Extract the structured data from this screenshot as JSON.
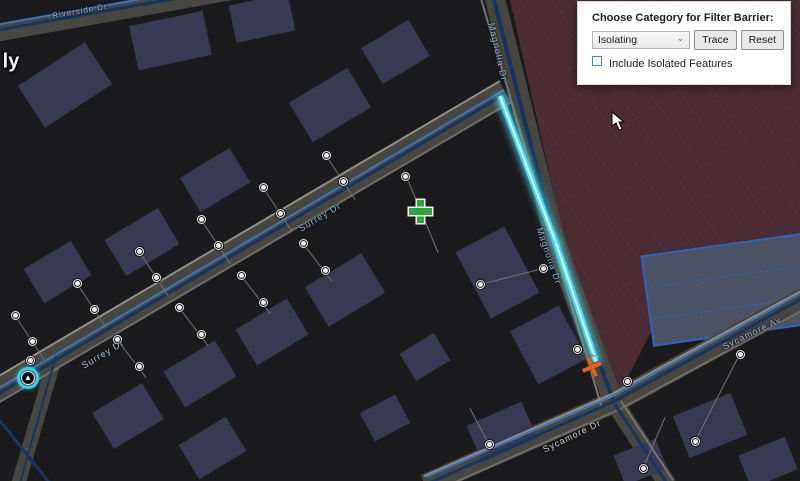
{
  "panel": {
    "title": "Choose Category for Filter Barrier:",
    "dropdown_value": "Isolating",
    "trace_label": "Trace",
    "reset_label": "Reset",
    "checkbox_label": "Include Isolated Features",
    "checkbox_checked": false
  },
  "map": {
    "colors": {
      "background": "#1b1b1e",
      "building": "#383a53",
      "road": "#474641",
      "road_edge": "#8f8d84",
      "water_main_dark": "#16365f",
      "water_main_blue": "#3b76bd",
      "trace_highlight": "#49dbf2",
      "red_zone": "#4a2c32",
      "lot_fill": "#4b5364",
      "lot_border": "#2d64c2",
      "label_blue": "#8fb3dd",
      "start_marker_green": "#2fa33c",
      "barrier_orange": "#e2621b"
    },
    "zones": {
      "red_clip": "polygon(510px 0px, 800px 0px, 800px 248px, 690px 255px, 652px 330px, 620px 392px, 565px 243px)",
      "lot": {
        "x": 733,
        "y": 289,
        "w": 175,
        "h": 92,
        "rot": -8
      }
    },
    "roads": [
      {
        "x1": -20,
        "y1": 400,
        "x2": 505,
        "y2": 92,
        "w": 22
      },
      {
        "x1": 494,
        "y1": -5,
        "x2": 556,
        "y2": 244,
        "w": 20
      },
      {
        "x1": 556,
        "y1": 244,
        "x2": 614,
        "y2": 404,
        "w": 20
      },
      {
        "x1": 425,
        "y1": 485,
        "x2": 614,
        "y2": 402,
        "w": 22
      },
      {
        "x1": 614,
        "y1": 402,
        "x2": 805,
        "y2": 298,
        "w": 22
      },
      {
        "x1": 614,
        "y1": 402,
        "x2": 668,
        "y2": 485,
        "w": 18
      },
      {
        "x1": -5,
        "y1": 34,
        "x2": 232,
        "y2": -8,
        "w": 16
      },
      {
        "x1": 55,
        "y1": 358,
        "x2": 18,
        "y2": 485,
        "w": 14
      }
    ],
    "lines": [
      {
        "x1": -25,
        "y1": 390,
        "x2": 500,
        "y2": 81,
        "w": 2,
        "c": "#8f8d84"
      },
      {
        "x1": -14,
        "y1": 410,
        "x2": 511,
        "y2": 102,
        "w": 1.5,
        "c": "#6e6c64"
      },
      {
        "x1": -18,
        "y1": 403,
        "x2": 503,
        "y2": 95,
        "w": 3,
        "c": "#16365f"
      },
      {
        "x1": -16,
        "y1": 397,
        "x2": 504,
        "y2": 90,
        "w": 2,
        "c": "#3b76bd"
      },
      {
        "x1": 481,
        "y1": -2,
        "x2": 602,
        "y2": 408,
        "w": 1.5,
        "c": "#76746c"
      },
      {
        "x1": 494,
        "y1": 0,
        "x2": 556,
        "y2": 244,
        "w": 4,
        "c": "#16365f"
      },
      {
        "x1": 556,
        "y1": 244,
        "x2": 613,
        "y2": 400,
        "w": 4,
        "c": "#16365f"
      },
      {
        "x1": 424,
        "y1": 476,
        "x2": 612,
        "y2": 394,
        "w": 2,
        "c": "#8f8d84"
      },
      {
        "x1": 433,
        "y1": 492,
        "x2": 618,
        "y2": 410,
        "w": 1.5,
        "c": "#6e6c64"
      },
      {
        "x1": 428,
        "y1": 483,
        "x2": 614,
        "y2": 401,
        "w": 3,
        "c": "#16365f"
      },
      {
        "x1": 426,
        "y1": 477,
        "x2": 613,
        "y2": 396,
        "w": 2,
        "c": "#3b76bd"
      },
      {
        "x1": 612,
        "y1": 394,
        "x2": 803,
        "y2": 290,
        "w": 2,
        "c": "#8f8d84"
      },
      {
        "x1": 618,
        "y1": 410,
        "x2": 805,
        "y2": 309,
        "w": 1.5,
        "c": "#6e6c64"
      },
      {
        "x1": 614,
        "y1": 401,
        "x2": 804,
        "y2": 297,
        "w": 3,
        "c": "#16365f"
      },
      {
        "x1": 613,
        "y1": 396,
        "x2": 803,
        "y2": 292,
        "w": 2,
        "c": "#3b76bd"
      },
      {
        "x1": 615,
        "y1": 404,
        "x2": 667,
        "y2": 483,
        "w": 3,
        "c": "#16365f"
      },
      {
        "x1": 621,
        "y1": 401,
        "x2": 673,
        "y2": 480,
        "w": 1.5,
        "c": "#76746c"
      },
      {
        "x1": -5,
        "y1": 30,
        "x2": 232,
        "y2": -12,
        "w": 3,
        "c": "#16365f"
      },
      {
        "x1": -5,
        "y1": 25,
        "x2": 232,
        "y2": -17,
        "w": 2,
        "c": "#3b76bd"
      },
      {
        "x1": 56,
        "y1": 356,
        "x2": 20,
        "y2": 483,
        "w": 2,
        "c": "#16365f"
      },
      {
        "x1": 0,
        "y1": 420,
        "x2": 50,
        "y2": 483,
        "w": 2.5,
        "c": "#16365f"
      }
    ],
    "highlight": [
      {
        "x1": 500,
        "y1": 96,
        "x2": 556,
        "y2": 243
      },
      {
        "x1": 556,
        "y1": 243,
        "x2": 596,
        "y2": 361
      }
    ],
    "connectors": [
      {
        "x1": 326,
        "y1": 155,
        "x2": 355,
        "y2": 199
      },
      {
        "x1": 263,
        "y1": 187,
        "x2": 292,
        "y2": 231
      },
      {
        "x1": 201,
        "y1": 219,
        "x2": 230,
        "y2": 263
      },
      {
        "x1": 139,
        "y1": 251,
        "x2": 168,
        "y2": 295
      },
      {
        "x1": 77,
        "y1": 283,
        "x2": 106,
        "y2": 327
      },
      {
        "x1": 15,
        "y1": 315,
        "x2": 44,
        "y2": 359
      },
      {
        "x1": 404,
        "y1": 170,
        "x2": 438,
        "y2": 252
      },
      {
        "x1": 303,
        "y1": 243,
        "x2": 332,
        "y2": 281
      },
      {
        "x1": 241,
        "y1": 275,
        "x2": 270,
        "y2": 313
      },
      {
        "x1": 179,
        "y1": 307,
        "x2": 208,
        "y2": 345
      },
      {
        "x1": 117,
        "y1": 339,
        "x2": 146,
        "y2": 377
      },
      {
        "x1": 543,
        "y1": 268,
        "x2": 480,
        "y2": 284
      },
      {
        "x1": 596,
        "y1": 356,
        "x2": 577,
        "y2": 349
      },
      {
        "x1": 738,
        "y1": 357,
        "x2": 695,
        "y2": 441
      },
      {
        "x1": 665,
        "y1": 417,
        "x2": 643,
        "y2": 468
      },
      {
        "x1": 489,
        "y1": 444,
        "x2": 470,
        "y2": 408
      }
    ],
    "devices": [
      {
        "x": 326,
        "y": 155
      },
      {
        "x": 263,
        "y": 187
      },
      {
        "x": 201,
        "y": 219
      },
      {
        "x": 139,
        "y": 251
      },
      {
        "x": 77,
        "y": 283
      },
      {
        "x": 15,
        "y": 315
      },
      {
        "x": 343,
        "y": 181
      },
      {
        "x": 280,
        "y": 213
      },
      {
        "x": 218,
        "y": 245
      },
      {
        "x": 156,
        "y": 277
      },
      {
        "x": 94,
        "y": 309
      },
      {
        "x": 32,
        "y": 341
      },
      {
        "x": 303,
        "y": 243
      },
      {
        "x": 241,
        "y": 275
      },
      {
        "x": 179,
        "y": 307
      },
      {
        "x": 117,
        "y": 339
      },
      {
        "x": 325,
        "y": 270
      },
      {
        "x": 263,
        "y": 302
      },
      {
        "x": 201,
        "y": 334
      },
      {
        "x": 139,
        "y": 366
      },
      {
        "x": 405,
        "y": 176
      },
      {
        "x": 543,
        "y": 268
      },
      {
        "x": 480,
        "y": 284
      },
      {
        "x": 577,
        "y": 349
      },
      {
        "x": 627,
        "y": 381
      },
      {
        "x": 740,
        "y": 354
      },
      {
        "x": 695,
        "y": 441
      },
      {
        "x": 643,
        "y": 468
      },
      {
        "x": 489,
        "y": 444
      },
      {
        "x": 30,
        "y": 360
      }
    ],
    "buildings": [
      {
        "x": 65,
        "y": 85,
        "w": 80,
        "h": 50,
        "rot": -33
      },
      {
        "x": 170,
        "y": 40,
        "w": 75,
        "h": 45,
        "rot": -12
      },
      {
        "x": 262,
        "y": 18,
        "w": 60,
        "h": 38,
        "rot": -12
      },
      {
        "x": 330,
        "y": 105,
        "w": 68,
        "h": 46,
        "rot": -31
      },
      {
        "x": 395,
        "y": 52,
        "w": 55,
        "h": 42,
        "rot": -31
      },
      {
        "x": 215,
        "y": 180,
        "w": 58,
        "h": 40,
        "rot": -31
      },
      {
        "x": 142,
        "y": 242,
        "w": 62,
        "h": 42,
        "rot": -31
      },
      {
        "x": 57,
        "y": 272,
        "w": 55,
        "h": 40,
        "rot": -31
      },
      {
        "x": 345,
        "y": 290,
        "w": 66,
        "h": 46,
        "rot": -31
      },
      {
        "x": 272,
        "y": 332,
        "w": 60,
        "h": 42,
        "rot": -31
      },
      {
        "x": 200,
        "y": 374,
        "w": 60,
        "h": 42,
        "rot": -31
      },
      {
        "x": 128,
        "y": 416,
        "w": 58,
        "h": 42,
        "rot": -31
      },
      {
        "x": 212,
        "y": 448,
        "w": 55,
        "h": 40,
        "rot": -31
      },
      {
        "x": 385,
        "y": 418,
        "w": 40,
        "h": 32,
        "rot": -28
      },
      {
        "x": 425,
        "y": 357,
        "w": 40,
        "h": 32,
        "rot": -31
      },
      {
        "x": 497,
        "y": 272,
        "w": 55,
        "h": 75,
        "rot": -28
      },
      {
        "x": 548,
        "y": 345,
        "w": 55,
        "h": 60,
        "rot": -28
      },
      {
        "x": 502,
        "y": 432,
        "w": 60,
        "h": 40,
        "rot": -24
      },
      {
        "x": 710,
        "y": 425,
        "w": 62,
        "h": 45,
        "rot": -22
      },
      {
        "x": 768,
        "y": 462,
        "w": 50,
        "h": 35,
        "rot": -22
      },
      {
        "x": 640,
        "y": 462,
        "w": 45,
        "h": 32,
        "rot": -22
      }
    ],
    "labels": [
      {
        "text": "Magnolia Dr",
        "x": 498,
        "y": 52,
        "rot": 77,
        "c": "#8fb3dd",
        "s": 9
      },
      {
        "text": "Magnolia Dr",
        "x": 549,
        "y": 256,
        "rot": 71,
        "c": "#8fb3dd",
        "s": 9
      },
      {
        "text": "Surrey Dr",
        "x": 320,
        "y": 217,
        "rot": -31,
        "c": "#8fb3dd",
        "s": 9
      },
      {
        "text": "Surrey Dr",
        "x": 103,
        "y": 354,
        "rot": -31,
        "c": "#a9c0de",
        "s": 9
      },
      {
        "text": "Sycamore Dr",
        "x": 572,
        "y": 436,
        "rot": -26,
        "c": "#cdd0cc",
        "s": 9
      },
      {
        "text": "Sycamore Av",
        "x": 752,
        "y": 333,
        "rot": -26,
        "c": "#9db5d6",
        "s": 9
      },
      {
        "text": "Riverside Dr",
        "x": 80,
        "y": 11,
        "rot": -10,
        "c": "#8fb3dd",
        "s": 8
      },
      {
        "text": "ly",
        "x": 11,
        "y": 62,
        "rot": 0,
        "c": "#f5f5f5",
        "s": 20,
        "b": true
      }
    ],
    "markers": {
      "start_point": {
        "x": 420,
        "y": 211
      },
      "filter_barrier": {
        "x": 592,
        "y": 367
      },
      "selected_device": {
        "x": 28,
        "y": 378
      },
      "cursor": {
        "x": 612,
        "y": 112
      }
    }
  }
}
